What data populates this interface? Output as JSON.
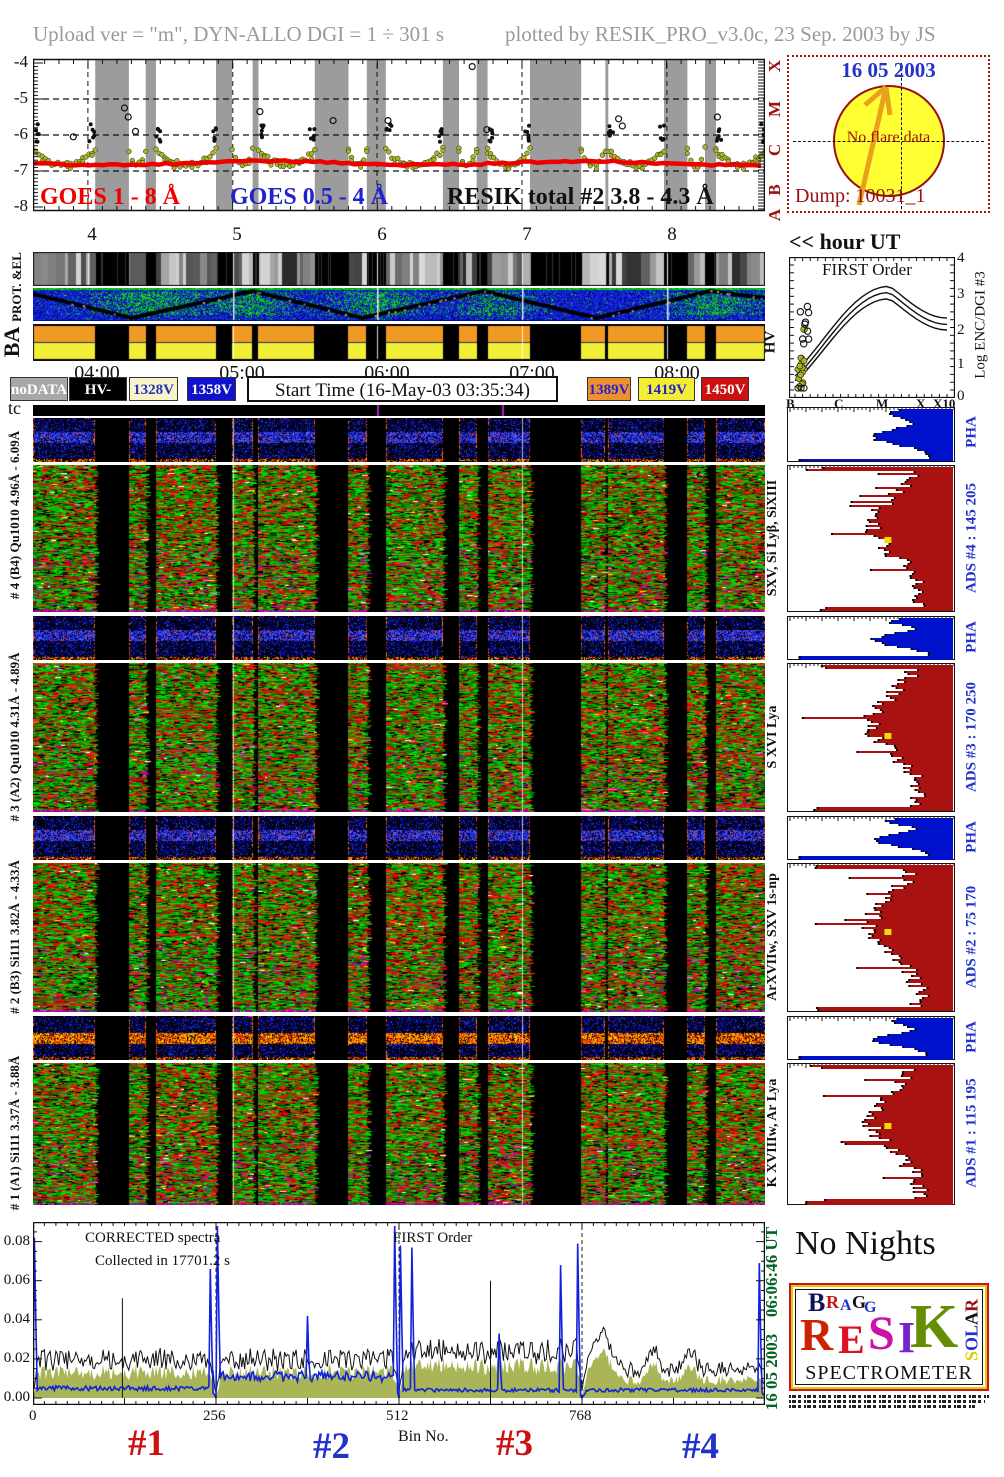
{
  "header": {
    "left": "Upload ver = \"m\", DYN-ALLO DGI =   1 ÷ 301 s",
    "right": "plotted by RESIK_PRO_v3.0c, 23 Sep. 2003 by JS"
  },
  "goes": {
    "ylabels": [
      "-4",
      "-5",
      "-6",
      "-7",
      "-8"
    ],
    "xlabels": [
      "4",
      "5",
      "6",
      "7",
      "8"
    ],
    "class_letters": [
      "X",
      "M",
      "C",
      "B",
      "A"
    ],
    "legend": [
      {
        "label": "GOES 1 - 8 Å",
        "color": "#ee0000"
      },
      {
        "label": "GOES 0.5 - 4 Å",
        "color": "#2222cc"
      },
      {
        "label": "RESIK total #2  3.8 - 4.3 Å",
        "color": "#111111"
      }
    ]
  },
  "flare_box": {
    "date": "16 05 2003",
    "message": "No flare data",
    "dump": "Dump: 10031_1",
    "sun_color": "#ffff33",
    "border_color": "#991111"
  },
  "hour_ut_label": "<< hour UT",
  "side_labels": {
    "prot": "PROT. &EL",
    "ba": "BA",
    "hv": "HV",
    "tc": "tc"
  },
  "time_axis": [
    "04:00",
    "05:00",
    "06:00",
    "07:00",
    "08:00"
  ],
  "legend_boxes": [
    {
      "label": "noDATA",
      "bg": "#a8a8a8",
      "fg": "#ffffff"
    },
    {
      "label": "HV-OFF",
      "bg": "#000000",
      "fg": "#ffffff"
    },
    {
      "label": "1328V",
      "bg": "#f8f3c9",
      "fg": "#2233bb"
    },
    {
      "label": "1358V",
      "bg": "#1111cc",
      "fg": "#ffffff"
    },
    {
      "label": "1389V",
      "bg": "#ef9030",
      "fg": "#2222cc"
    },
    {
      "label": "1419V",
      "bg": "#f2ee35",
      "fg": "#2222cc"
    },
    {
      "label": "1450V",
      "bg": "#cc1111",
      "fg": "#ffffff"
    }
  ],
  "start_time_label": "Start Time (16-May-03 03:35:34)",
  "first_order": {
    "title": "FIRST Order",
    "xlabels": [
      "B",
      "C",
      "M",
      "X",
      "X10"
    ],
    "ylabels": [
      "4",
      "3",
      "2",
      "1",
      "0"
    ],
    "ylabel": "Log ENC/DGI #3"
  },
  "channels": [
    {
      "num": "#4",
      "left_label": "# 4 (B4) Qu1010 4.96Å - 6.09Å",
      "right_label": "SXV, Si Lyβ, SiXIII",
      "ads_label": "ADS #4 :  145 205",
      "pha_label": "PHA"
    },
    {
      "num": "#3",
      "left_label": "# 3 (A2) Qu1010 4.31Å - 4.89Å",
      "right_label": "S XVI Lya",
      "ads_label": "ADS #3 :  170 250",
      "pha_label": "PHA"
    },
    {
      "num": "#2",
      "left_label": "# 2 (B3) Si111 3.82Å - 4.33Å",
      "right_label": "ArXVIIw, SXV 1s-np",
      "ads_label": "ADS #2 :  75 170",
      "pha_label": "PHA"
    },
    {
      "num": "#1",
      "left_label": "# 1 (A1) Si111 3.37Å - 3.88Å",
      "right_label": "K XVIIIw, Ar Lya",
      "ads_label": "ADS #1 :  115 195",
      "pha_label": "PHA"
    }
  ],
  "bottom": {
    "note1": "CORRECTED spectra",
    "note2": "Collected in 17701.2 s",
    "note3": "FIRST Order",
    "ylabels": [
      "0.08",
      "0.06",
      "0.04",
      "0.02",
      "0.00"
    ],
    "xlabels": [
      "0",
      "256",
      "512",
      "768"
    ],
    "xlabel": "Bin No.",
    "tags": [
      {
        "label": "#1",
        "color": "#cc1111"
      },
      {
        "label": "#2",
        "color": "#2233cc"
      },
      {
        "label": "#3",
        "color": "#cc1111"
      },
      {
        "label": "#4",
        "color": "#2233cc"
      }
    ],
    "side_date": "16 05 2003",
    "side_time": "06:06:46 UT"
  },
  "no_nights": "No Nights",
  "logo": {
    "letters_top": [
      {
        "ch": "B",
        "c": "#101060"
      },
      {
        "ch": "R",
        "c": "#cc1111"
      },
      {
        "ch": "A",
        "c": "#2233cc"
      },
      {
        "ch": "G",
        "c": "#111111"
      },
      {
        "ch": "G",
        "c": "#2233cc"
      }
    ],
    "letters_main": [
      {
        "ch": "R",
        "c": "#cc2200"
      },
      {
        "ch": "E",
        "c": "#dd1122"
      },
      {
        "ch": "S",
        "c": "#cc11aa"
      },
      {
        "ch": "I",
        "c": "#7722cc"
      },
      {
        "ch": "K",
        "c": "#668c00"
      }
    ],
    "letters_side": [
      {
        "ch": "S",
        "c": "#ddcc00"
      },
      {
        "ch": "O",
        "c": "#2233cc"
      },
      {
        "ch": "L",
        "c": "#2233cc"
      },
      {
        "ch": "A",
        "c": "#111111"
      },
      {
        "ch": "R",
        "c": "#991111"
      }
    ],
    "word_bottom": "SPECTROMETER"
  },
  "chart_data": [
    {
      "id": "goes_lightcurve",
      "type": "scatter",
      "title": "GOES and RESIK X-ray lightcurves",
      "xlabel": "hour UT",
      "xlim": [
        3.62,
        8.68
      ],
      "ylabel": "log10 flux",
      "ylim": [
        -8,
        -4
      ],
      "grid_hours": [
        4,
        5,
        6,
        7,
        8
      ],
      "goes_classes": {
        "A": -8,
        "B": -7,
        "C": -6,
        "M": -5,
        "X": -4
      },
      "series": [
        {
          "name": "GOES 1 - 8 Å",
          "color": "#ee0000",
          "style": "thick_line",
          "level": -6.78
        },
        {
          "name": "GOES 0.5 - 4 Å",
          "color": "#2222cc",
          "style": "labeled_only"
        },
        {
          "name": "RESIK total #2 3.8 - 4.3 Å",
          "color": "#a9b41e",
          "style": "dots",
          "orbit_min": -6.88,
          "orbit_edge": -6.4,
          "edge_spike_top": -5.4
        }
      ],
      "data_segments": [
        [
          0.0,
          0.085
        ],
        [
          0.131,
          0.154
        ],
        [
          0.168,
          0.25
        ],
        [
          0.272,
          0.3
        ],
        [
          0.308,
          0.385
        ],
        [
          0.431,
          0.456
        ],
        [
          0.482,
          0.56
        ],
        [
          0.582,
          0.606
        ],
        [
          0.621,
          0.679
        ],
        [
          0.749,
          0.782
        ],
        [
          0.786,
          0.862
        ],
        [
          0.894,
          0.918
        ],
        [
          0.933,
          1.0
        ]
      ],
      "hour_marks_frac": [
        0.075,
        0.273,
        0.47,
        0.668,
        0.866
      ]
    },
    {
      "id": "first_order",
      "type": "line",
      "title": "FIRST Order",
      "x_categories": [
        "B",
        "C",
        "M",
        "X",
        "X10"
      ],
      "ylabel": "Log ENC/DGI #3",
      "ylim": [
        0,
        4
      ],
      "curves": [
        {
          "start": 0.62,
          "peak": 3.32,
          "peak_x": 0.62,
          "end": 2.3
        },
        {
          "start": 0.45,
          "peak": 3.12,
          "peak_x": 0.62,
          "end": 2.1
        },
        {
          "start": 0.3,
          "peak": 2.92,
          "peak_x": 0.62,
          "end": 1.92
        }
      ],
      "scatter": {
        "filled_color": "#a9b41e",
        "filled_x_range": [
          0.015,
          0.07
        ],
        "filled_y_range": [
          0.05,
          1.2
        ],
        "open_y_range": [
          1.45,
          2.7
        ]
      }
    },
    {
      "id": "spectrograms",
      "type": "heatmap",
      "panels": [
        {
          "channel": "#4",
          "crystal": "B4 Qu1010",
          "range_A": "4.96-6.09"
        },
        {
          "channel": "#3",
          "crystal": "A2 Qu1010",
          "range_A": "4.31-4.89"
        },
        {
          "channel": "#2",
          "crystal": "B3 Si111",
          "range_A": "3.82-4.33"
        },
        {
          "channel": "#1",
          "crystal": "A1 Si111",
          "range_A": "3.37-3.88"
        }
      ]
    },
    {
      "id": "corrected_spectra",
      "type": "line",
      "title": "CORRECTED spectra",
      "xlabel": "Bin No.",
      "xlim": [
        0,
        1024
      ],
      "ylim": [
        0,
        0.09
      ],
      "dashed_bins": [
        256,
        512,
        768
      ],
      "olive_baseline": [
        0.013,
        0.013,
        0.016,
        0.009
      ],
      "blue_baseline": [
        0.005,
        0.011,
        0.004,
        0.004
      ],
      "blue_spikes": [
        [
          3,
          0.082
        ],
        [
          248,
          0.066
        ],
        [
          258,
          0.094
        ],
        [
          385,
          0.042
        ],
        [
          506,
          0.094
        ],
        [
          514,
          0.078
        ],
        [
          531,
          0.077
        ],
        [
          652,
          0.033
        ],
        [
          739,
          0.068
        ],
        [
          762,
          0.079
        ],
        [
          1016,
          0.069
        ]
      ],
      "black_spikes": [
        [
          125,
          0.051
        ],
        [
          640,
          0.06
        ]
      ],
      "olive_bumps": [
        [
          795,
          0.014,
          18
        ],
        [
          868,
          0.008,
          10
        ],
        [
          920,
          0.007,
          10
        ]
      ]
    }
  ]
}
